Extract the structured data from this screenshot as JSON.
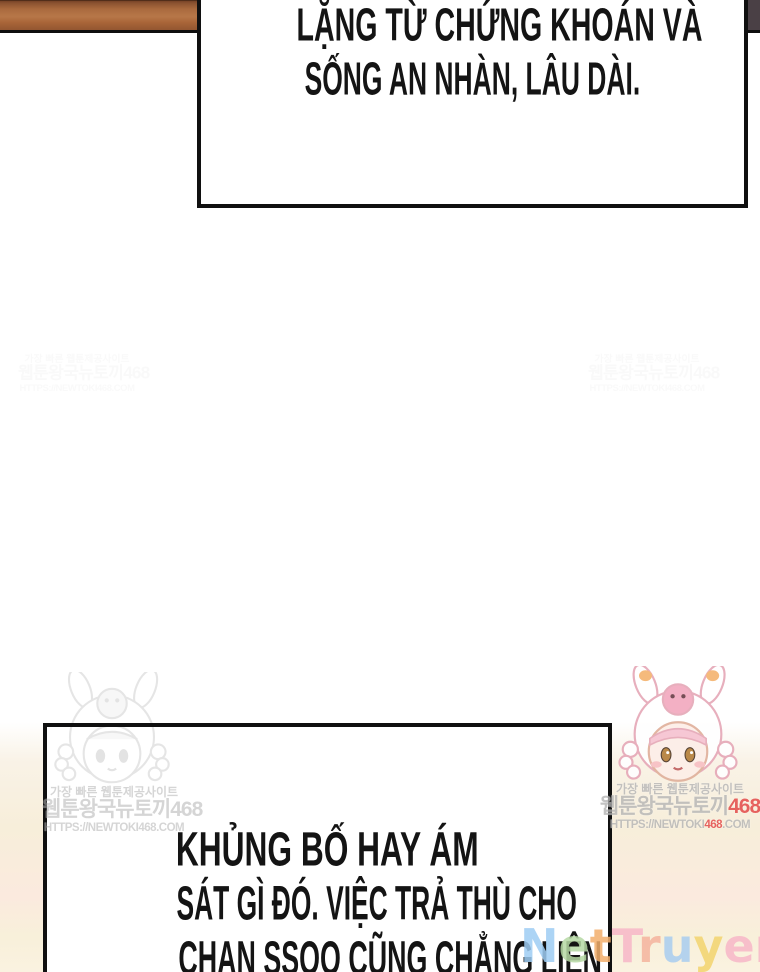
{
  "page": {
    "type": "webtoon-comic-page",
    "background": "#ffffff"
  },
  "panel_artwork": {
    "wood_shelf_color": "#a96a3e",
    "dark_corner_color": "#4a4045",
    "cream_background_color": "#f7eeda",
    "pink_band_color": "#fbeade",
    "bubble_border_color": "#101010"
  },
  "speech_bubbles": {
    "top": {
      "lines": [
        "LẶNG TỪ CHỨNG KHOÁN VÀ",
        "SỐNG AN NHÀN, LÂU DÀI."
      ]
    },
    "bottom": {
      "lines": [
        "KHỦNG BỐ HAY ÁM",
        "SÁT GÌ ĐÓ. VIỆC TRẢ THÙ CHO",
        "CHAN SSOO CŨNG CHẲNG LIÊN"
      ]
    }
  },
  "watermarks": {
    "korean_line1": "가장 빠른 웹툰제공사이트",
    "korean_line2_prefix": "웹툰왕국뉴토끼",
    "korean_line2_number": "468",
    "url_prefix": "HTTPS://NEWTOKI",
    "url_number": "468",
    "url_suffix": ".COM",
    "red_accent_color": "#e23b3b"
  },
  "site_logo": {
    "text": "NetTruyen1905",
    "letters": [
      {
        "ch": "N",
        "color": "#9ecdf4"
      },
      {
        "ch": "e",
        "color": "#b6d9a4"
      },
      {
        "ch": "t",
        "color": "#f3ae6c"
      },
      {
        "ch": "T",
        "color": "#f7b7c8"
      },
      {
        "ch": "r",
        "color": "#f5b49e"
      },
      {
        "ch": "u",
        "color": "#a9cdf0"
      },
      {
        "ch": "y",
        "color": "#f3d46e"
      },
      {
        "ch": "e",
        "color": "#f7b7c8"
      },
      {
        "ch": "n",
        "color": "#f7b7c8"
      },
      {
        "ch": "1",
        "color": "#cfc3c9"
      },
      {
        "ch": "9",
        "color": "#f7b7c8"
      },
      {
        "ch": "0",
        "color": "#f3d46e"
      },
      {
        "ch": "5",
        "color": "#f3ae6c"
      }
    ]
  },
  "mascots": {
    "left": "faint-gray-chibi-girl-in-rabbit-hood",
    "right": "pink-chibi-girl-in-rabbit-hood"
  }
}
